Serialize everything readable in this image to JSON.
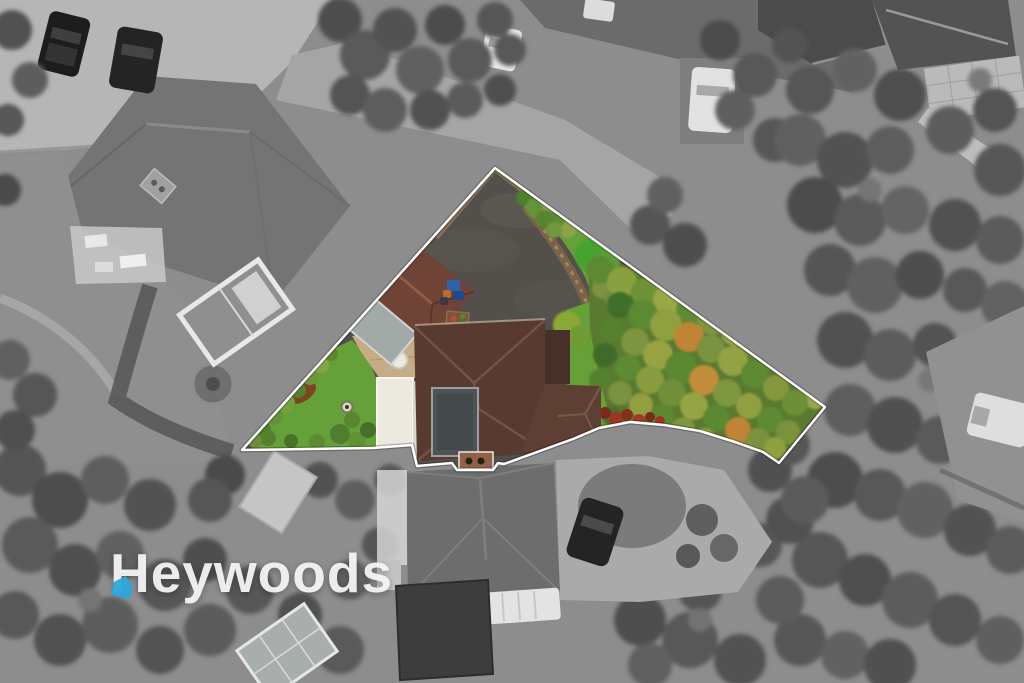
{
  "watermark": {
    "brand_text": "Heywoods",
    "icon": "house-pin-icon",
    "text_color": "#f4f4f4",
    "icon_color": "#2fa7db"
  },
  "scene": {
    "canvas_width": 1024,
    "canvas_height": 683,
    "boundary_points": "495,168 825,407 779,463 763,452 735,442 700,431 664,425 630,422 599,428 573,439 504,464 498,463 493,470 457,470 452,463 417,466 412,445 373,448 242,450",
    "palette": {
      "outline": "#ffffff",
      "bg_gray": "#8d8d8d",
      "asphalt": "#53504b",
      "lawn": "#66a039",
      "tree_underlay": "#5a7a31",
      "roof_main": "#583a30",
      "roof_garage": "#6f4336",
      "flat_roof": "#4e5356",
      "carport": "#a2aaa8",
      "patio": "#c7ac83",
      "white_building": "#eceade",
      "soil": "#7a6248",
      "fence": "#8a7456",
      "red_shrub": "#8a2e1c"
    },
    "trees_color": [
      [
        543,
        213,
        10,
        "#7d8f3e"
      ],
      [
        556,
        222,
        9,
        "#5d8c31"
      ],
      [
        568,
        230,
        8,
        "#8fa24a"
      ],
      [
        548,
        205,
        8,
        "#98a050"
      ],
      [
        592,
        255,
        17,
        "#46a42e"
      ],
      [
        608,
        262,
        12,
        "#5d9a35"
      ],
      [
        603,
        288,
        11,
        "#7d9140"
      ],
      [
        615,
        300,
        10,
        "#6f8c3c"
      ],
      [
        524,
        198,
        8,
        "#4f7f2b"
      ],
      [
        534,
        208,
        9,
        "#649338"
      ],
      [
        545,
        219,
        9,
        "#55862f"
      ],
      [
        554,
        230,
        8,
        "#6f9a3c"
      ],
      [
        567,
        325,
        14,
        "#8aa835"
      ],
      [
        580,
        336,
        11,
        "#6f9a34"
      ],
      [
        600,
        270,
        14,
        "#5c8a33"
      ],
      [
        622,
        282,
        15,
        "#8aa03f"
      ],
      [
        645,
        292,
        14,
        "#6f9138"
      ],
      [
        668,
        300,
        15,
        "#9aa843"
      ],
      [
        690,
        310,
        14,
        "#5f8a33"
      ],
      [
        712,
        320,
        15,
        "#7e9440"
      ],
      [
        735,
        332,
        14,
        "#97a244"
      ],
      [
        757,
        345,
        13,
        "#6b8d36"
      ],
      [
        778,
        358,
        13,
        "#8da23f"
      ],
      [
        797,
        372,
        12,
        "#5e8631"
      ],
      [
        810,
        386,
        12,
        "#7f9640"
      ],
      [
        815,
        398,
        11,
        "#98a84a"
      ],
      [
        620,
        305,
        13,
        "#3f6f2a"
      ],
      [
        643,
        315,
        15,
        "#5b8a33"
      ],
      [
        666,
        325,
        16,
        "#8fa041"
      ],
      [
        689,
        337,
        15,
        "#c08534"
      ],
      [
        711,
        349,
        14,
        "#7a9340"
      ],
      [
        733,
        361,
        15,
        "#93a243"
      ],
      [
        755,
        374,
        14,
        "#5e8a34"
      ],
      [
        776,
        388,
        13,
        "#84973d"
      ],
      [
        795,
        403,
        13,
        "#6d8f38"
      ],
      [
        612,
        330,
        12,
        "#56822f"
      ],
      [
        635,
        342,
        14,
        "#7d9440"
      ],
      [
        658,
        355,
        15,
        "#97a342"
      ],
      [
        681,
        368,
        16,
        "#5b8833"
      ],
      [
        704,
        380,
        15,
        "#c28d3a"
      ],
      [
        727,
        393,
        14,
        "#7e9640"
      ],
      [
        749,
        406,
        13,
        "#90a041"
      ],
      [
        770,
        420,
        13,
        "#5f8a35"
      ],
      [
        788,
        432,
        12,
        "#7b923d"
      ],
      [
        605,
        355,
        12,
        "#3f6b28"
      ],
      [
        628,
        368,
        13,
        "#5d8a33"
      ],
      [
        650,
        380,
        14,
        "#8a9c40"
      ],
      [
        672,
        393,
        14,
        "#6f9038"
      ],
      [
        694,
        406,
        14,
        "#96a443"
      ],
      [
        716,
        418,
        13,
        "#5c8833"
      ],
      [
        738,
        430,
        13,
        "#c08434"
      ],
      [
        758,
        440,
        12,
        "#7a923e"
      ],
      [
        775,
        448,
        11,
        "#8fa041"
      ],
      [
        600,
        380,
        11,
        "#55812e"
      ],
      [
        620,
        393,
        12,
        "#7b9340"
      ],
      [
        641,
        405,
        12,
        "#929f41"
      ],
      [
        662,
        417,
        12,
        "#5d8833"
      ],
      [
        683,
        429,
        12,
        "#7f9540"
      ],
      [
        704,
        440,
        12,
        "#93a243"
      ],
      [
        724,
        448,
        11,
        "#5f8a34"
      ],
      [
        744,
        452,
        10,
        "#84973e"
      ],
      [
        612,
        416,
        10,
        "#4a7029"
      ],
      [
        630,
        428,
        10,
        "#6f8f3a"
      ],
      [
        650,
        438,
        10,
        "#8a9c40"
      ],
      [
        668,
        446,
        9,
        "#5c8832"
      ]
    ],
    "red_shrubs": [
      [
        583,
        413,
        7,
        "#8a2e1c"
      ],
      [
        594,
        418,
        6,
        "#a13b24"
      ],
      [
        605,
        413,
        6,
        "#7c2a1a"
      ],
      [
        616,
        419,
        7,
        "#993722"
      ],
      [
        627,
        415,
        6,
        "#8a2e1c"
      ],
      [
        639,
        420,
        6,
        "#a13b24"
      ],
      [
        650,
        417,
        5,
        "#7c2a1a"
      ],
      [
        660,
        421,
        5,
        "#993722"
      ]
    ],
    "left_hedge": [
      [
        262,
        430,
        9,
        "#4e7c2c"
      ],
      [
        274,
        416,
        9,
        "#639239"
      ],
      [
        286,
        403,
        9,
        "#76a03e"
      ],
      [
        298,
        390,
        8,
        "#557f2e"
      ],
      [
        310,
        377,
        8,
        "#6b963a"
      ],
      [
        321,
        365,
        8,
        "#7fa746"
      ],
      [
        331,
        354,
        7,
        "#5a8631"
      ],
      [
        268,
        438,
        8,
        "#55802e"
      ],
      [
        291,
        441,
        7,
        "#4a732a"
      ],
      [
        317,
        442,
        8,
        "#5d8a33"
      ],
      [
        340,
        434,
        10,
        "#517d2e"
      ],
      [
        357,
        441,
        9,
        "#629136"
      ],
      [
        368,
        430,
        8,
        "#46702a"
      ],
      [
        352,
        420,
        8,
        "#588631"
      ],
      [
        255,
        441,
        7,
        "#6e8a38"
      ]
    ],
    "trees_gray": [
      [
        340,
        20,
        22,
        "#4e4e4e"
      ],
      [
        365,
        55,
        25,
        "#5a5a5a"
      ],
      [
        395,
        30,
        22,
        "#525252"
      ],
      [
        420,
        70,
        24,
        "#606060"
      ],
      [
        445,
        25,
        20,
        "#4c4c4c"
      ],
      [
        470,
        60,
        22,
        "#5a5a5a"
      ],
      [
        495,
        20,
        18,
        "#565656"
      ],
      [
        350,
        95,
        20,
        "#545454"
      ],
      [
        385,
        110,
        22,
        "#5e5e5e"
      ],
      [
        430,
        110,
        20,
        "#515151"
      ],
      [
        465,
        100,
        18,
        "#5b5b5b"
      ],
      [
        500,
        90,
        16,
        "#4f4f4f"
      ],
      [
        510,
        50,
        16,
        "#585858"
      ],
      [
        720,
        40,
        20,
        "#4c4c4c"
      ],
      [
        755,
        75,
        22,
        "#585858"
      ],
      [
        790,
        45,
        18,
        "#535353"
      ],
      [
        735,
        110,
        20,
        "#5f5f5f"
      ],
      [
        775,
        140,
        22,
        "#565656"
      ],
      [
        650,
        225,
        20,
        "#555555"
      ],
      [
        685,
        245,
        22,
        "#4e4e4e"
      ],
      [
        665,
        195,
        18,
        "#606060"
      ],
      [
        810,
        90,
        24,
        "#565656"
      ],
      [
        855,
        70,
        22,
        "#616161"
      ],
      [
        900,
        95,
        26,
        "#4f4f4f"
      ],
      [
        950,
        130,
        24,
        "#5d5d5d"
      ],
      [
        995,
        110,
        22,
        "#545454"
      ],
      [
        800,
        140,
        26,
        "#606060"
      ],
      [
        845,
        160,
        28,
        "#525252"
      ],
      [
        890,
        150,
        24,
        "#5e5e5e"
      ],
      [
        1000,
        170,
        26,
        "#575757"
      ],
      [
        815,
        205,
        28,
        "#4c4c4c"
      ],
      [
        860,
        220,
        26,
        "#5a5a5a"
      ],
      [
        905,
        210,
        24,
        "#646464"
      ],
      [
        955,
        225,
        26,
        "#515151"
      ],
      [
        1000,
        240,
        24,
        "#5b5b5b"
      ],
      [
        830,
        270,
        26,
        "#555555"
      ],
      [
        875,
        285,
        28,
        "#606060"
      ],
      [
        920,
        275,
        24,
        "#4e4e4e"
      ],
      [
        965,
        290,
        22,
        "#585858"
      ],
      [
        1005,
        305,
        24,
        "#626262"
      ],
      [
        845,
        340,
        28,
        "#515151"
      ],
      [
        890,
        355,
        26,
        "#5c5c5c"
      ],
      [
        935,
        345,
        22,
        "#535353"
      ],
      [
        850,
        410,
        26,
        "#5e5e5e"
      ],
      [
        895,
        425,
        28,
        "#505050"
      ],
      [
        940,
        440,
        24,
        "#5a5a5a"
      ],
      [
        985,
        455,
        26,
        "#555555"
      ],
      [
        835,
        480,
        28,
        "#4d4d4d"
      ],
      [
        880,
        495,
        26,
        "#585858"
      ],
      [
        925,
        510,
        28,
        "#616161"
      ],
      [
        970,
        530,
        26,
        "#525252"
      ],
      [
        1010,
        550,
        24,
        "#5c5c5c"
      ],
      [
        820,
        560,
        28,
        "#565656"
      ],
      [
        865,
        580,
        26,
        "#4f4f4f"
      ],
      [
        910,
        600,
        28,
        "#5d5d5d"
      ],
      [
        955,
        620,
        26,
        "#545454"
      ],
      [
        1000,
        640,
        24,
        "#5f5f5f"
      ],
      [
        800,
        640,
        26,
        "#575757"
      ],
      [
        845,
        655,
        24,
        "#616161"
      ],
      [
        890,
        665,
        26,
        "#505050"
      ],
      [
        640,
        620,
        26,
        "#4e4e4e"
      ],
      [
        690,
        640,
        28,
        "#585858"
      ],
      [
        740,
        660,
        26,
        "#525252"
      ],
      [
        780,
        600,
        24,
        "#5c5c5c"
      ],
      [
        700,
        590,
        22,
        "#555555"
      ],
      [
        650,
        665,
        22,
        "#606060"
      ],
      [
        760,
        545,
        22,
        "#575757"
      ],
      [
        790,
        520,
        24,
        "#515151"
      ],
      [
        770,
        470,
        22,
        "#505050"
      ],
      [
        805,
        500,
        24,
        "#5b5b5b"
      ],
      [
        790,
        445,
        20,
        "#565656"
      ],
      [
        20,
        470,
        26,
        "#555555"
      ],
      [
        60,
        500,
        28,
        "#4d4d4d"
      ],
      [
        105,
        480,
        24,
        "#5e5e5e"
      ],
      [
        150,
        505,
        26,
        "#525252"
      ],
      [
        30,
        545,
        28,
        "#5a5a5a"
      ],
      [
        75,
        570,
        26,
        "#4f4f4f"
      ],
      [
        120,
        555,
        24,
        "#606060"
      ],
      [
        165,
        585,
        26,
        "#565656"
      ],
      [
        15,
        615,
        24,
        "#585858"
      ],
      [
        60,
        640,
        26,
        "#515151"
      ],
      [
        110,
        625,
        28,
        "#5d5d5d"
      ],
      [
        160,
        650,
        24,
        "#535353"
      ],
      [
        210,
        630,
        26,
        "#5b5b5b"
      ],
      [
        205,
        560,
        22,
        "#4e4e4e"
      ],
      [
        250,
        590,
        24,
        "#575757"
      ],
      [
        300,
        615,
        22,
        "#505050"
      ],
      [
        340,
        650,
        24,
        "#5a5a5a"
      ],
      [
        350,
        580,
        20,
        "#616161"
      ],
      [
        380,
        545,
        18,
        "#555555"
      ],
      [
        225,
        475,
        20,
        "#4a4a4a"
      ],
      [
        210,
        500,
        22,
        "#565656"
      ],
      [
        320,
        480,
        18,
        "#525252"
      ],
      [
        355,
        500,
        20,
        "#5e5e5e"
      ],
      [
        390,
        480,
        16,
        "#575757"
      ],
      [
        10,
        360,
        20,
        "#606060"
      ],
      [
        35,
        395,
        22,
        "#565656"
      ],
      [
        15,
        430,
        20,
        "#4f4f4f"
      ],
      [
        12,
        30,
        20,
        "#515151"
      ],
      [
        30,
        80,
        18,
        "#5d5d5d"
      ],
      [
        8,
        120,
        16,
        "#575757"
      ],
      [
        5,
        190,
        16,
        "#4a4a4a"
      ],
      [
        870,
        190,
        12,
        "#757575"
      ],
      [
        930,
        380,
        12,
        "#787878"
      ],
      [
        90,
        600,
        12,
        "#747474"
      ],
      [
        700,
        620,
        12,
        "#727272"
      ],
      [
        980,
        80,
        12,
        "#7a7a7a"
      ]
    ]
  }
}
